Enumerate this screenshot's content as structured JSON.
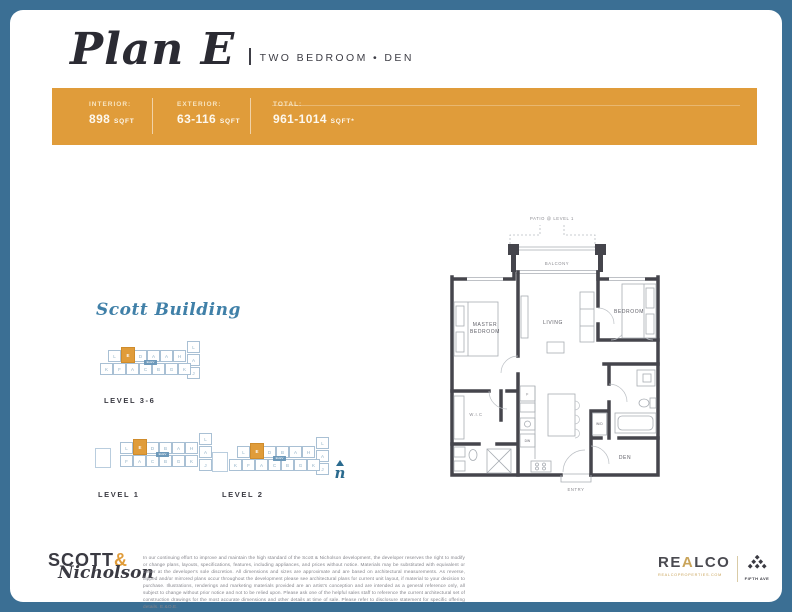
{
  "header": {
    "title": "Plan E",
    "subtitle": "TWO BEDROOM • DEN"
  },
  "banner": {
    "stats": [
      {
        "label": "INTERIOR:",
        "value": "898",
        "unit": "SQFT"
      },
      {
        "label": "EXTERIOR:",
        "value": "63-116",
        "unit": "SQFT"
      },
      {
        "label": "TOTAL:",
        "value": "961-1014",
        "unit": "SQFT*"
      }
    ]
  },
  "keyplans": {
    "building_name": "Scott Building",
    "elev_label": "ELEV",
    "levels": [
      {
        "label": "LEVEL 3-6",
        "hl": "E",
        "top": [
          "L",
          "E",
          "D",
          "A",
          "A",
          "H"
        ],
        "right": [
          "L",
          "A",
          "J"
        ],
        "bottom": [
          "K",
          "F",
          "A",
          "C",
          "B",
          "G",
          "K"
        ],
        "annex": false
      },
      {
        "label": "LEVEL 1",
        "hl": "E",
        "top": [
          "L",
          "E",
          "D",
          "B",
          "A",
          "H"
        ],
        "right": [
          "L",
          "A",
          "J"
        ],
        "bottom": [
          "F",
          "A",
          "C",
          "B",
          "G",
          "K"
        ],
        "annex": true
      },
      {
        "label": "LEVEL 2",
        "hl": "E",
        "top": [
          "L",
          "E",
          "D",
          "B",
          "A",
          "H"
        ],
        "right": [
          "L",
          "A",
          "J"
        ],
        "bottom": [
          "K",
          "F",
          "A",
          "C",
          "B",
          "G",
          "K"
        ],
        "annex": true
      }
    ],
    "north_label": "n"
  },
  "floorplan": {
    "labels": {
      "patio": "PATIO @ LEVEL 1",
      "balcony": "BALCONY",
      "master_line1": "MASTER",
      "master_line2": "BEDROOM",
      "living": "LIVING",
      "bedroom": "BEDROOM",
      "wic": "W.I.C",
      "den": "DEN",
      "entry": "ENTRY",
      "wd": "W/D",
      "fridge": "F",
      "dw": "DW"
    }
  },
  "footer": {
    "brand_top": "SCOTT",
    "brand_amp": "&",
    "brand_script": "Nicholson",
    "disclaimer": "In our continuing effort to improve and maintain the high standard of the Scott & Nicholson development, the developer reserves the right to modify or change plans, layouts, specifications, features, including appliances, and prices without notice. Materials may be substituted with equivalent or better at the developer's sole discretion. All dimensions and sizes are approximate and are based on architectural measurements. As reverse, flipped and/or mirrored plans occur throughout the development please see architectural plans for current unit layout, if material to your decision to purchase. Illustrations, renderings and marketing materials provided are an artist's conception and are intended as a general reference only, all subject to change without prior notice and not to be relied upon. Please ask one of the helpful sales staff to reference the current architectural set of construction drawings for the most accurate dimensions and other details at time of sale. Please refer to disclosure statement for specific offering details. E.&O.E.",
    "realco_pre": "RE",
    "realco_a": "A",
    "realco_post": "LCO",
    "realco_url": "REALCOPROPERTIES.COM",
    "fifthave": "FIFTH AVE"
  },
  "colors": {
    "accent_orange": "#e09c3a",
    "frame_blue": "#3b6f94",
    "script_blue": "#4080a8",
    "gold": "#c9a45a"
  }
}
